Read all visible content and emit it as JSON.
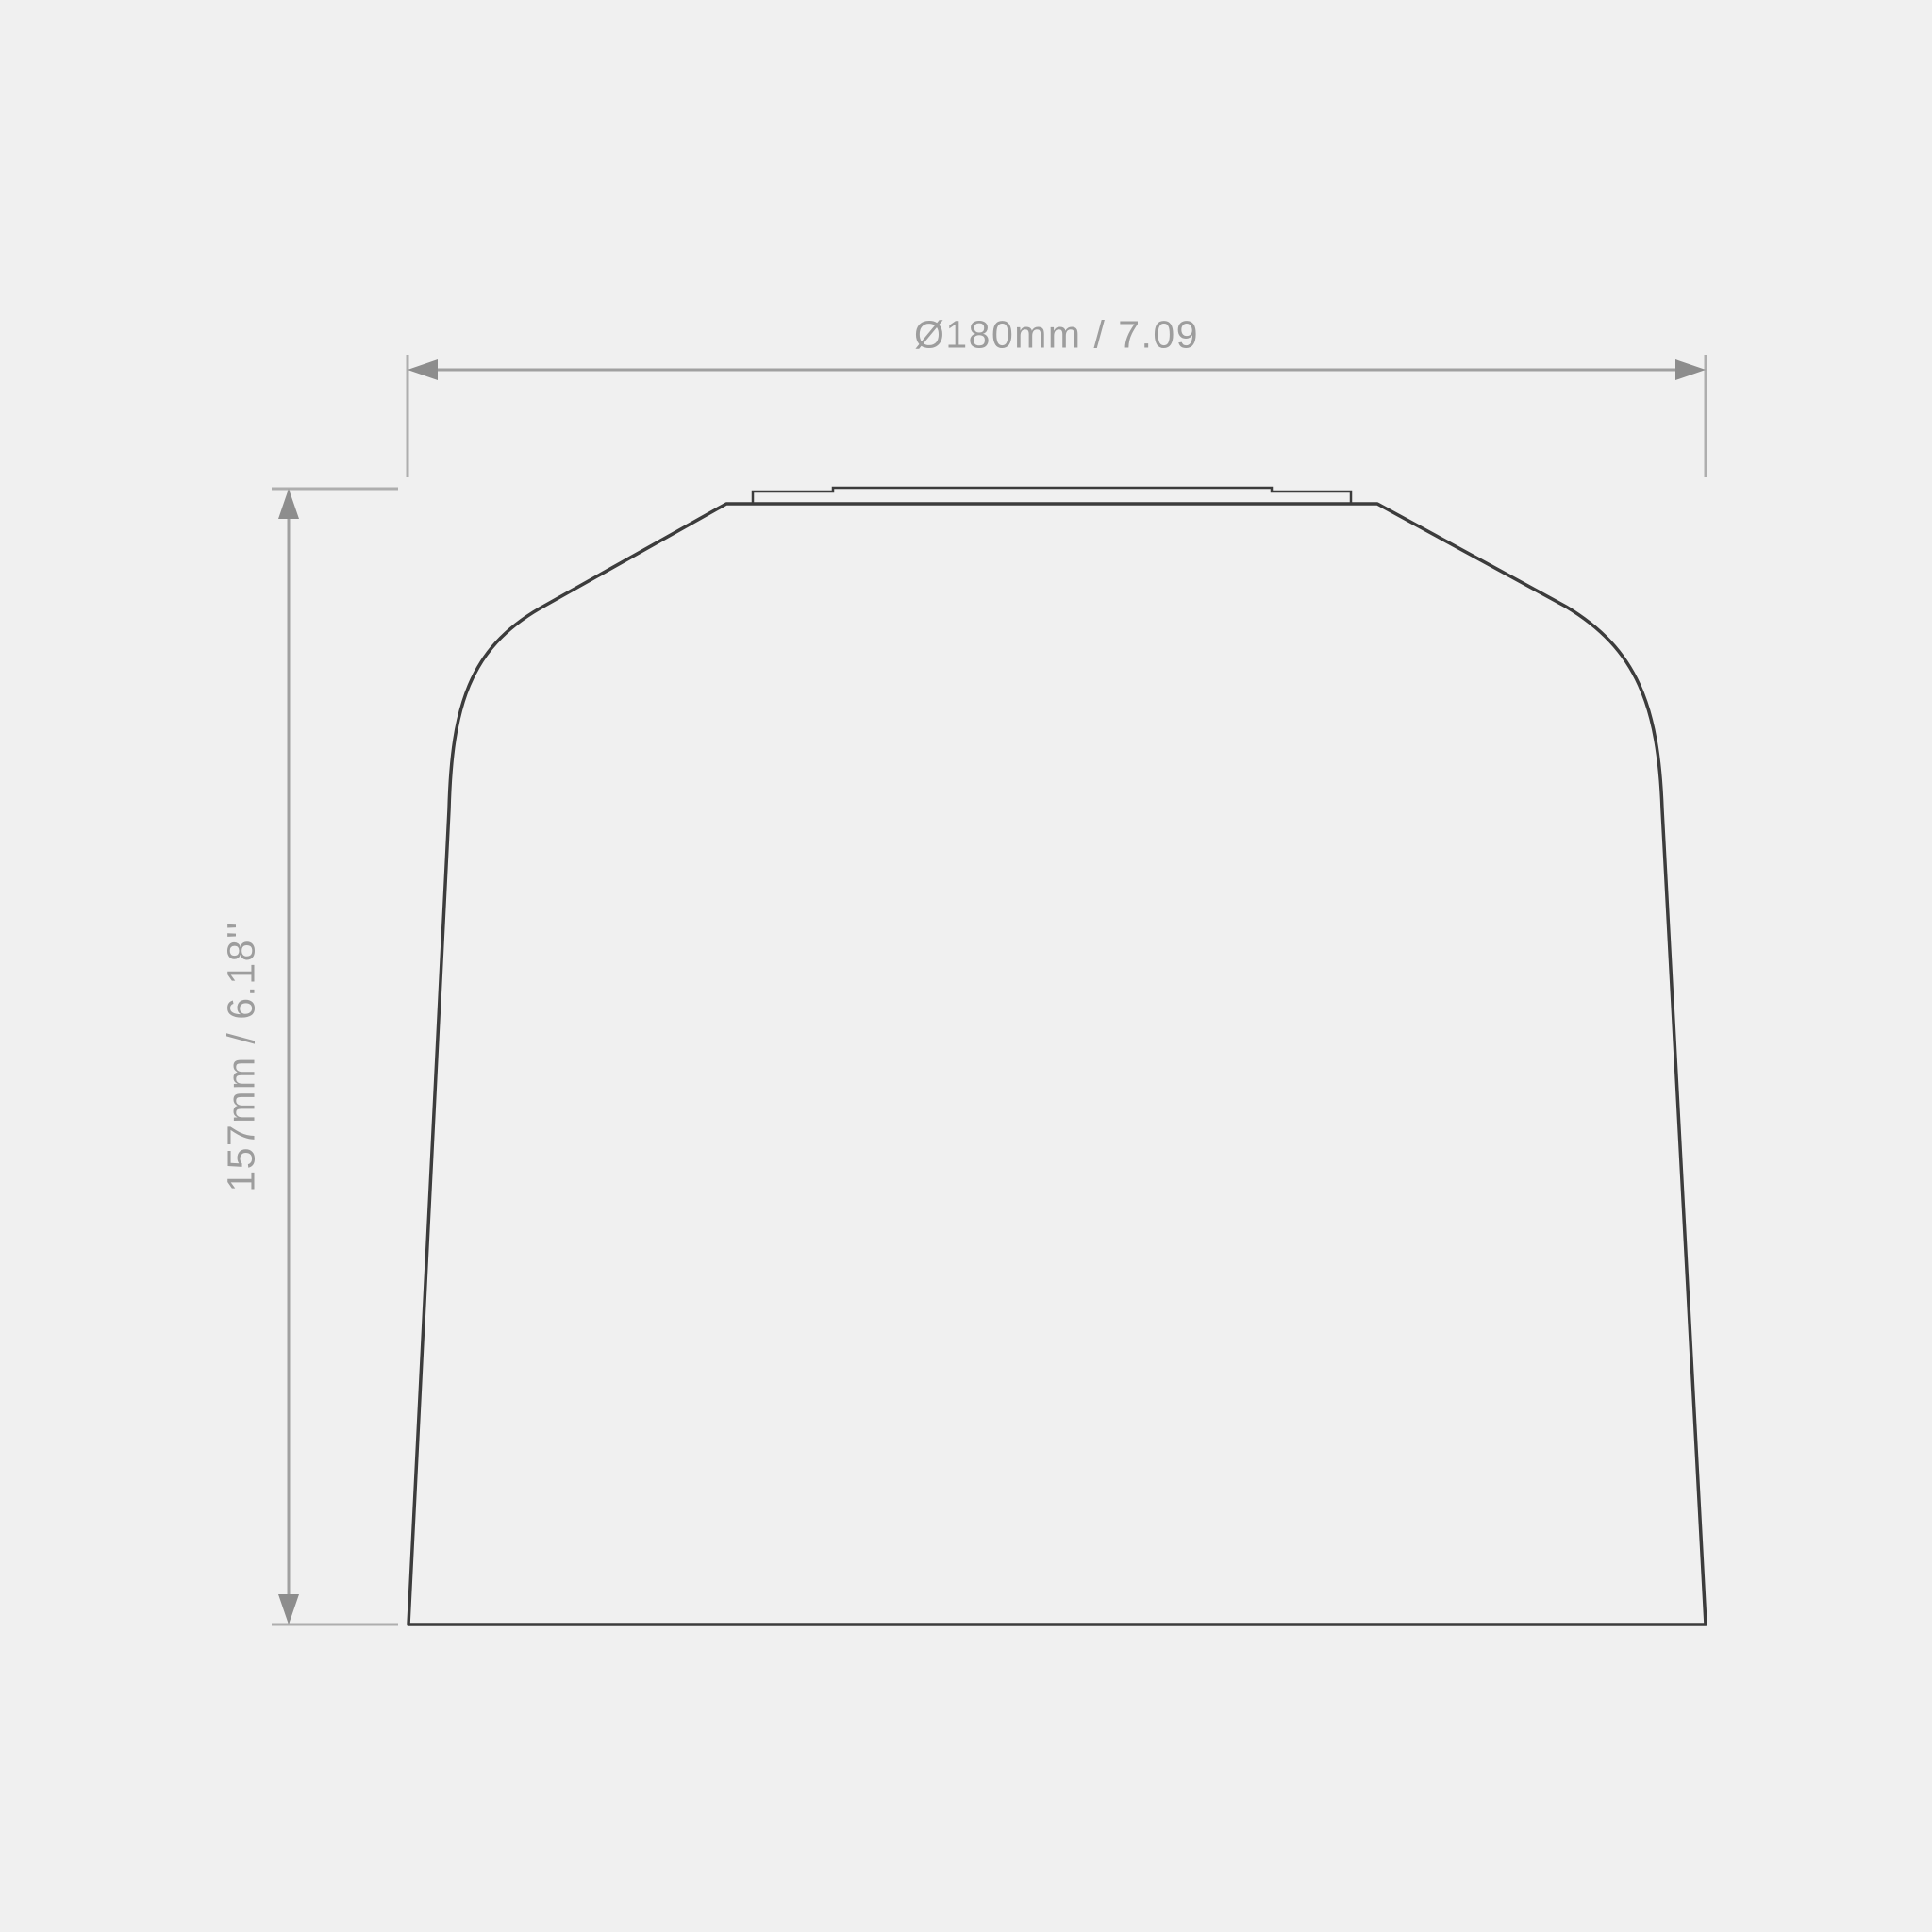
{
  "page": {
    "background_color": "#f0f0f0"
  },
  "drawing": {
    "outline_color": "#3c3c3c",
    "dimension_color": "#a0a0a0",
    "label_color": "#9d9d9d",
    "dimensions": {
      "width_label": "Ø180mm / 7.09",
      "height_label": "157mm / 6.18''"
    }
  }
}
